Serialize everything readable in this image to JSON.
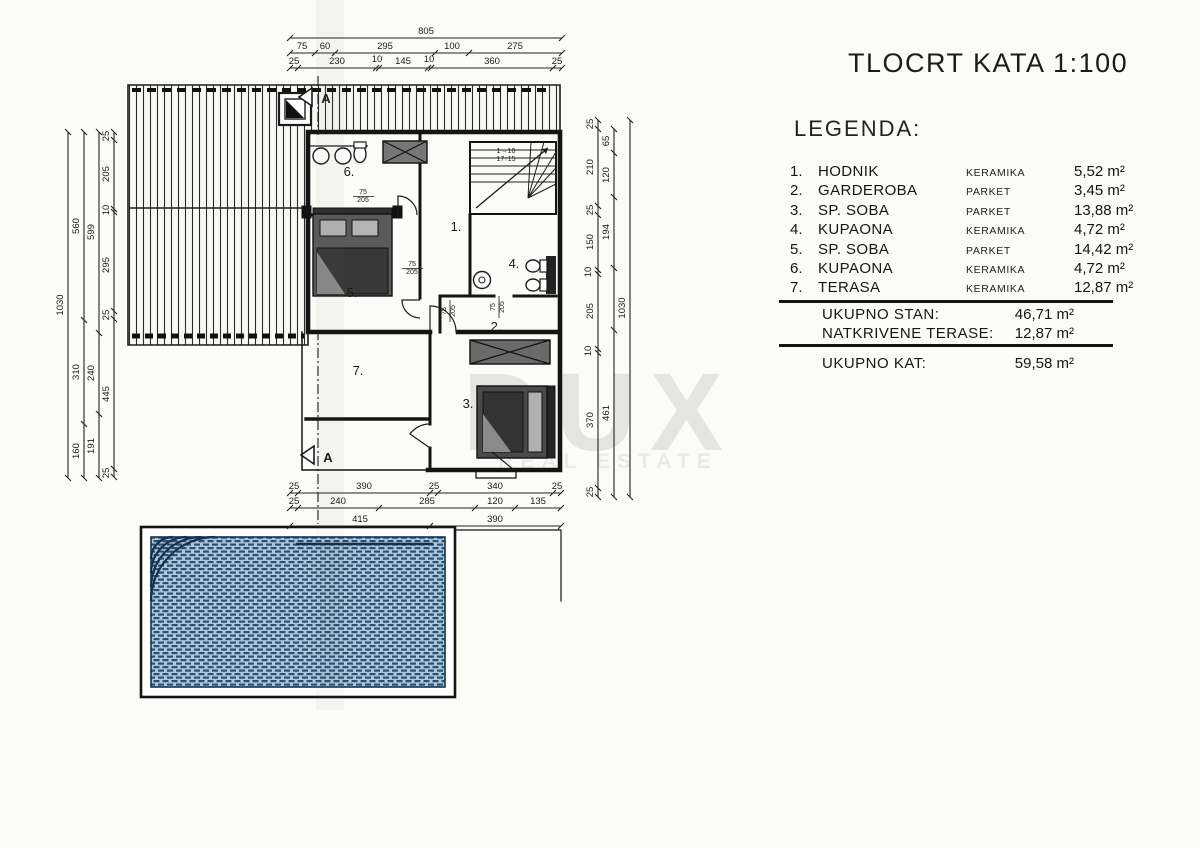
{
  "title": "TLOCRT KATA 1:100",
  "legend": {
    "heading": "LEGENDA:",
    "rows": [
      {
        "num": "1.",
        "name": "HODNIK",
        "material": "KERAMIKA",
        "area": "5,52 m²"
      },
      {
        "num": "2.",
        "name": "GARDEROBA",
        "material": "PARKET",
        "area": "3,45 m²"
      },
      {
        "num": "3.",
        "name": "SP. SOBA",
        "material": "PARKET",
        "area": "13,88 m²"
      },
      {
        "num": "4.",
        "name": "KUPAONA",
        "material": "KERAMIKA",
        "area": "4,72 m²"
      },
      {
        "num": "5.",
        "name": "SP. SOBA",
        "material": "PARKET",
        "area": "14,42 m²"
      },
      {
        "num": "6.",
        "name": "KUPAONA",
        "material": "KERAMIKA",
        "area": "4,72 m²"
      },
      {
        "num": "7.",
        "name": "TERASA",
        "material": "KERAMIKA",
        "area": "12,87 m²"
      }
    ],
    "totals": [
      {
        "label": "UKUPNO STAN:",
        "value": "46,71 m²"
      },
      {
        "label": "NATKRIVENE TERASE:",
        "value": "12,87 m²"
      }
    ],
    "grand_total": {
      "label": "UKUPNO KAT:",
      "value": "59,58 m²"
    }
  },
  "watermark": {
    "line1": "DUX",
    "line2": "REAL ESTATE",
    "color": "#e4e4e1"
  },
  "plan": {
    "scale_note": "1:100",
    "colors": {
      "ink": "#1c1c1c",
      "pool_fill": "#aac7dd",
      "pool_line": "#2c5175"
    },
    "section_marker": "A",
    "stair_note": [
      "1→10",
      "17↑15"
    ],
    "door_size_label": "75/205",
    "room_numbers": [
      "1.",
      "2.",
      "3.",
      "4.",
      "5.",
      "6.",
      "7."
    ],
    "dimensions": {
      "top": [
        [
          "805"
        ],
        [
          "75",
          "60",
          "295",
          "100",
          "275"
        ],
        [
          "25",
          "230",
          "10",
          "145",
          "10",
          "360",
          "25"
        ]
      ],
      "left": [
        [
          "1030"
        ],
        [
          "560",
          "310",
          "160"
        ],
        [
          "599",
          "240",
          "191"
        ],
        [
          "25",
          "205",
          "10",
          "295",
          "25",
          "445",
          "25"
        ]
      ],
      "right": [
        [
          "25",
          "210",
          "25",
          "150",
          "10",
          "205",
          "10",
          "370",
          "25"
        ],
        [
          "65",
          "120",
          "194",
          "461"
        ],
        [
          "1030"
        ]
      ],
      "bottom": [
        [
          "25",
          "390",
          "25",
          "340",
          "25"
        ],
        [
          "25",
          "240",
          "285",
          "120",
          "135"
        ],
        [
          "415",
          "390"
        ]
      ]
    },
    "labels": [
      {
        "t": "805",
        "x": 426,
        "y": 34
      },
      {
        "t": "75",
        "x": 302,
        "y": 49
      },
      {
        "t": "60",
        "x": 325,
        "y": 49
      },
      {
        "t": "295",
        "x": 385,
        "y": 49
      },
      {
        "t": "100",
        "x": 452,
        "y": 49
      },
      {
        "t": "275",
        "x": 515,
        "y": 49
      },
      {
        "t": "25",
        "x": 294,
        "y": 64
      },
      {
        "t": "230",
        "x": 337,
        "y": 64
      },
      {
        "t": "10",
        "x": 377,
        "y": 62
      },
      {
        "t": "145",
        "x": 403,
        "y": 64
      },
      {
        "t": "10",
        "x": 429,
        "y": 62
      },
      {
        "t": "360",
        "x": 492,
        "y": 64
      },
      {
        "t": "25",
        "x": 557,
        "y": 64
      },
      {
        "t": "1030",
        "x": 63,
        "y": 305,
        "r": -90
      },
      {
        "t": "560",
        "x": 79,
        "y": 226,
        "r": -90
      },
      {
        "t": "310",
        "x": 79,
        "y": 372,
        "r": -90
      },
      {
        "t": "160",
        "x": 79,
        "y": 451,
        "r": -90
      },
      {
        "t": "599",
        "x": 94,
        "y": 232,
        "r": -90
      },
      {
        "t": "240",
        "x": 94,
        "y": 373,
        "r": -90
      },
      {
        "t": "191",
        "x": 94,
        "y": 446,
        "r": -90
      },
      {
        "t": "25",
        "x": 109,
        "y": 136,
        "r": -90
      },
      {
        "t": "205",
        "x": 109,
        "y": 174,
        "r": -90
      },
      {
        "t": "10",
        "x": 109,
        "y": 210,
        "r": -90
      },
      {
        "t": "295",
        "x": 109,
        "y": 265,
        "r": -90
      },
      {
        "t": "25",
        "x": 109,
        "y": 315,
        "r": -90
      },
      {
        "t": "445",
        "x": 109,
        "y": 394,
        "r": -90
      },
      {
        "t": "25",
        "x": 109,
        "y": 473,
        "r": -90
      },
      {
        "t": "25",
        "x": 593,
        "y": 124,
        "r": -90
      },
      {
        "t": "210",
        "x": 593,
        "y": 167,
        "r": -90
      },
      {
        "t": "25",
        "x": 593,
        "y": 210,
        "r": -90
      },
      {
        "t": "150",
        "x": 593,
        "y": 242,
        "r": -90
      },
      {
        "t": "10",
        "x": 591,
        "y": 272,
        "r": -90
      },
      {
        "t": "205",
        "x": 593,
        "y": 311,
        "r": -90
      },
      {
        "t": "10",
        "x": 591,
        "y": 351,
        "r": -90
      },
      {
        "t": "370",
        "x": 593,
        "y": 420,
        "r": -90
      },
      {
        "t": "25",
        "x": 593,
        "y": 492,
        "r": -90
      },
      {
        "t": "65",
        "x": 609,
        "y": 141,
        "r": -90
      },
      {
        "t": "120",
        "x": 609,
        "y": 175,
        "r": -90
      },
      {
        "t": "194",
        "x": 609,
        "y": 232,
        "r": -90
      },
      {
        "t": "461",
        "x": 609,
        "y": 413,
        "r": -90
      },
      {
        "t": "1030",
        "x": 625,
        "y": 308,
        "r": -90
      },
      {
        "t": "25",
        "x": 294,
        "y": 489
      },
      {
        "t": "390",
        "x": 364,
        "y": 489
      },
      {
        "t": "25",
        "x": 434,
        "y": 489
      },
      {
        "t": "340",
        "x": 495,
        "y": 489
      },
      {
        "t": "25",
        "x": 557,
        "y": 489
      },
      {
        "t": "25",
        "x": 294,
        "y": 504
      },
      {
        "t": "240",
        "x": 338,
        "y": 504
      },
      {
        "t": "285",
        "x": 427,
        "y": 504
      },
      {
        "t": "120",
        "x": 495,
        "y": 504
      },
      {
        "t": "135",
        "x": 538,
        "y": 504
      },
      {
        "t": "415",
        "x": 360,
        "y": 522
      },
      {
        "t": "390",
        "x": 495,
        "y": 522
      },
      {
        "t": "1.",
        "x": 456,
        "y": 231,
        "s": 13
      },
      {
        "t": "2.",
        "x": 496,
        "y": 331,
        "s": 13
      },
      {
        "t": "3.",
        "x": 468,
        "y": 408,
        "s": 13
      },
      {
        "t": "4.",
        "x": 514,
        "y": 268,
        "s": 13
      },
      {
        "t": "5.",
        "x": 352,
        "y": 297,
        "s": 13
      },
      {
        "t": "6.",
        "x": 349,
        "y": 176,
        "s": 13
      },
      {
        "t": "7.",
        "x": 358,
        "y": 375,
        "s": 13
      },
      {
        "t": "75",
        "x": 363,
        "y": 194,
        "s": 7
      },
      {
        "t": "205",
        "x": 363,
        "y": 202,
        "s": 7
      },
      {
        "t": "75",
        "x": 412,
        "y": 266,
        "s": 7
      },
      {
        "t": "205",
        "x": 412,
        "y": 274,
        "s": 7
      },
      {
        "t": "75",
        "x": 446,
        "y": 311,
        "r": -90,
        "s": 7
      },
      {
        "t": "205",
        "x": 455,
        "y": 311,
        "r": -90,
        "s": 7
      },
      {
        "t": "75",
        "x": 495,
        "y": 307,
        "r": -90,
        "s": 7
      },
      {
        "t": "205",
        "x": 504,
        "y": 307,
        "r": -90,
        "s": 7
      },
      {
        "t": "1→10",
        "x": 506,
        "y": 153,
        "s": 7
      },
      {
        "t": "17↑15",
        "x": 506,
        "y": 161,
        "s": 7
      },
      {
        "t": "A",
        "x": 326,
        "y": 103,
        "s": 13,
        "w": "bold"
      },
      {
        "t": "A",
        "x": 328,
        "y": 462,
        "s": 13,
        "w": "bold"
      }
    ]
  }
}
